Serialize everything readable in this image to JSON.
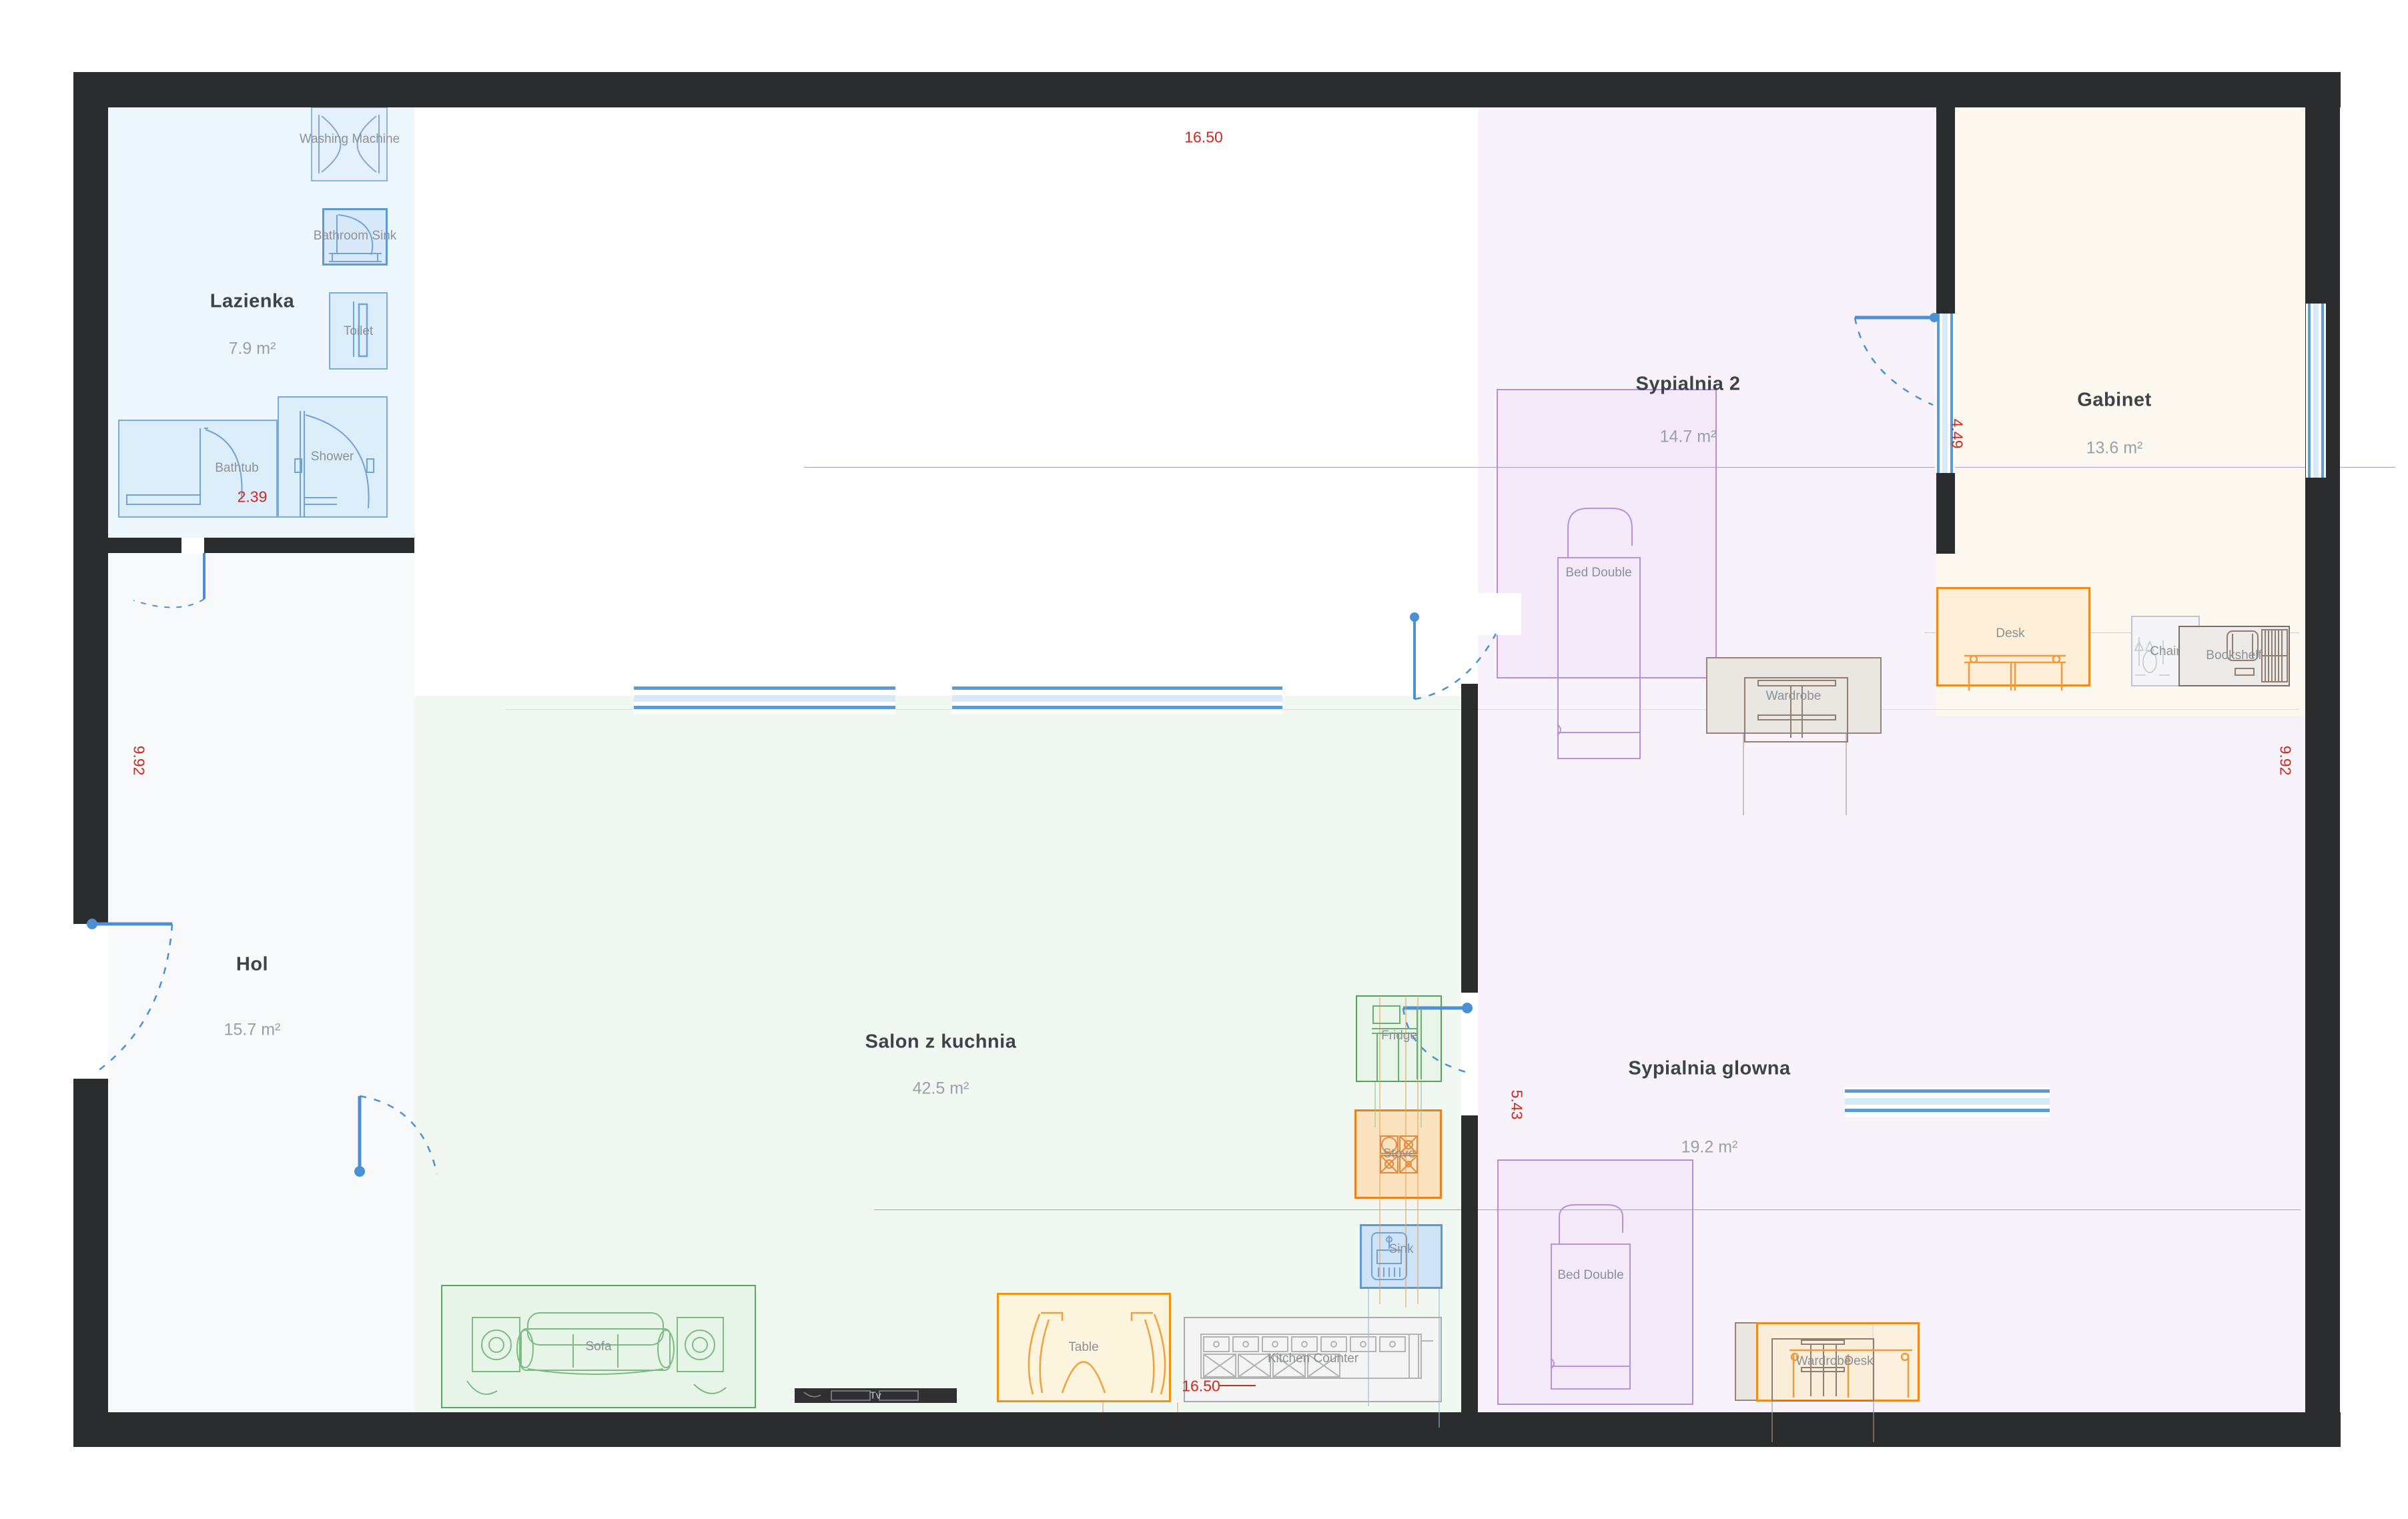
{
  "rooms": [
    {
      "name": "Lazienka",
      "area": "7.9 m²"
    },
    {
      "name": "Hol",
      "area": "15.7 m²"
    },
    {
      "name": "Salon z kuchnia",
      "area": "42.5 m²"
    },
    {
      "name": "Sypialnia 2",
      "area": "14.7 m²"
    },
    {
      "name": "Sypialnia glowna",
      "area": "19.2 m²"
    },
    {
      "name": "Gabinet",
      "area": "13.6 m²"
    }
  ],
  "furniture": {
    "washing_machine": "Washing Machine",
    "bathroom_sink": "Bathroom Sink",
    "toilet": "Toilet",
    "bathtub": "Bathtub",
    "shower": "Shower",
    "sofa": "Sofa",
    "table": "Table",
    "kitchen_counter": "Kitchen Counter",
    "tv": "Tv",
    "fridge": "Fridge",
    "stove": "Stove",
    "sink": "Sink",
    "bed_double_2": "Bed Double",
    "wardrobe_2": "Wardrobe",
    "desk_gabinet": "Desk",
    "chair": "Chair",
    "bookshelf": "Bookshelf",
    "bed_double_main": "Bed Double",
    "wardrobe_main": "Wardrobe",
    "desk_main": "Desk"
  },
  "dimensions": {
    "top_width": "16.50",
    "bottom_width": "16.50",
    "left_height": "9.92",
    "right_height": "9.92",
    "bathtub_width": "2.39",
    "gabinet_height": "4.49",
    "sypialnia_glowna_height": "5.43"
  },
  "colors": {
    "wall": "#2b2c2e",
    "dimension_text": "#cd2a21",
    "selection_orange": "#ef8b1d",
    "selection_blue": "#5b9bd5",
    "room_lazienka": "#eef7fd",
    "room_hol": "#f8f9fa",
    "room_salon": "#f1f8f2",
    "room_sypialnia": "#f8f3fb",
    "room_gabinet": "#fdf8ef"
  }
}
